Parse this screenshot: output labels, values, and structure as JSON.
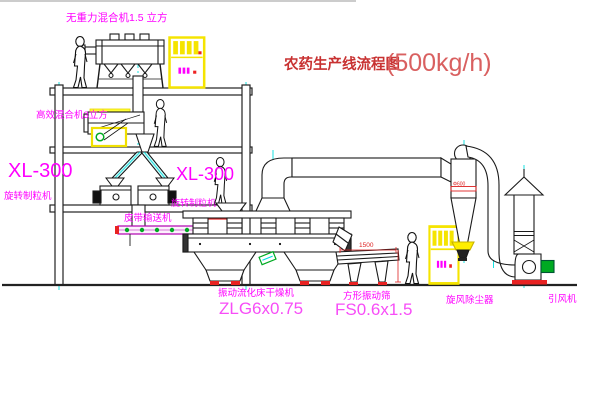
{
  "diagram": {
    "title": {
      "main": "农药生产线流程图",
      "capacity": "(500kg/h)"
    },
    "equipment_labels": {
      "gravity_mixer": "无重力混合机1.5 立方",
      "high_efficiency_mixer": "高效混合机3立方",
      "granulator_left_model": "XL-300",
      "granulator_left_name": "旋转制粒机",
      "granulator_right_model": "XL-300",
      "granulator_right_name": "旋转制粒机",
      "belt_conveyor": "皮带输送机",
      "fluid_bed_dryer_name": "振动流化床干燥机",
      "fluid_bed_dryer_model": "ZLG6x0.75",
      "vibrating_sieve_name": "方形振动筛",
      "vibrating_sieve_model": "FS0.6x1.5",
      "cyclone_name": "旋风除尘器",
      "fan_name": "引风机"
    },
    "dimensions": {
      "sieve_length": "1500",
      "cyclone_diameter": "Φ600"
    },
    "colors": {
      "label_magenta": "#ff00ff",
      "title_red": "#c83232",
      "centerline_cyan": "#00dede",
      "cabinet_yellow": "#f5e400",
      "accent_green": "#00aa22",
      "base_red": "#e82222",
      "line_black": "#1a1a1a",
      "background": "#ffffff"
    }
  }
}
